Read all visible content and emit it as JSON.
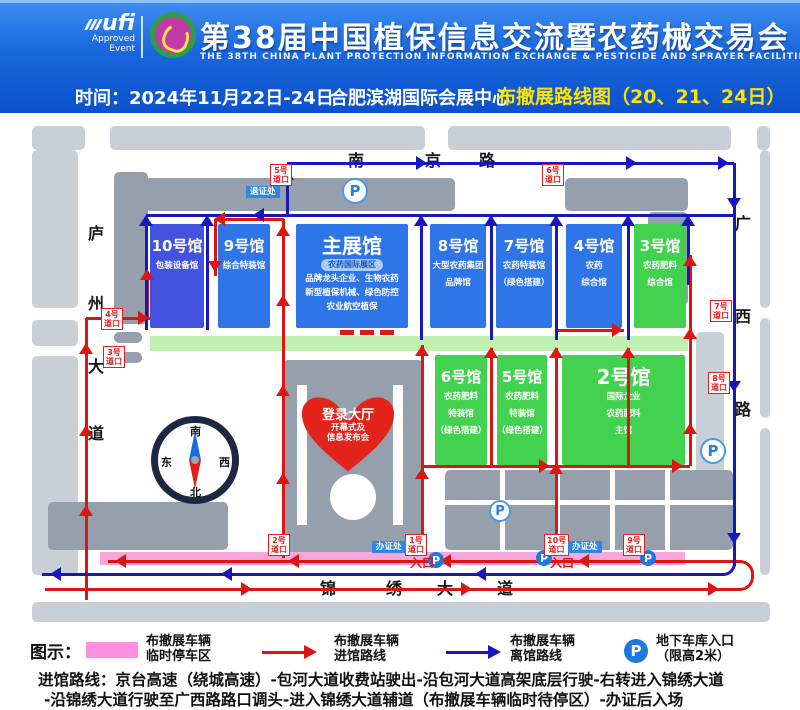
{
  "header": {
    "ufi": {
      "brand": "ufi",
      "approved": "Approved",
      "event": "Event"
    },
    "title": "第38届中国植保信息交流暨农药械交易会",
    "subtitle": "THE 38TH CHINA PLANT PROTECTION INFORMATION EXCHANGE & PESTICIDE AND SPRAYER FACILITIES FAIR",
    "time": "时间：2024年11月22日-24日",
    "venue": "合肥滨湖国际会展中心",
    "route_map_title": "布撤展路线图（20、21、24日）",
    "colors": {
      "header_top": "#3f8ef2",
      "header_bottom": "#0b51cc",
      "highlight": "#ffe300"
    }
  },
  "map": {
    "roads": {
      "north": "南京路",
      "west": "庐州大道",
      "east": "广西路",
      "south": "锦绣大道"
    },
    "halls": [
      {
        "id": "hall10",
        "name": "10号馆",
        "sub": [
          "包装设备馆"
        ],
        "color": "#4353e0",
        "x": 150,
        "y": 224,
        "w": 54,
        "h": 104,
        "big": false
      },
      {
        "id": "hall9",
        "name": "9号馆",
        "sub": [
          "综合特装馆"
        ],
        "color": "#2e75e8",
        "x": 218,
        "y": 224,
        "w": 52,
        "h": 104,
        "big": false
      },
      {
        "id": "main-hall",
        "name": "主展馆",
        "badge": "农药国际展区",
        "sub": [
          "品牌龙头企业、生物农药",
          "新型植保机械、绿色防控",
          "农业航空植保"
        ],
        "color": "#2e75e8",
        "x": 296,
        "y": 224,
        "w": 112,
        "h": 104,
        "big": true
      },
      {
        "id": "hall8",
        "name": "8号馆",
        "sub": [
          "大型农药集团",
          "品牌馆"
        ],
        "color": "#2e75e8",
        "x": 430,
        "y": 224,
        "w": 56,
        "h": 104,
        "big": false
      },
      {
        "id": "hall7",
        "name": "7号馆",
        "sub": [
          "农药特装馆",
          "（绿色搭建）"
        ],
        "color": "#2e75e8",
        "x": 496,
        "y": 224,
        "w": 56,
        "h": 104,
        "big": false
      },
      {
        "id": "hall4",
        "name": "4号馆",
        "sub": [
          "农药",
          "综合馆"
        ],
        "color": "#2e75e8",
        "x": 566,
        "y": 224,
        "w": 56,
        "h": 104,
        "big": false
      },
      {
        "id": "hall3",
        "name": "3号馆",
        "sub": [
          "农药肥料",
          "综合馆"
        ],
        "color": "#43d24f",
        "x": 634,
        "y": 224,
        "w": 52,
        "h": 104,
        "big": false
      },
      {
        "id": "hall6",
        "name": "6号馆",
        "sub": [
          "农药肥料",
          "特装馆",
          "（绿色搭建）"
        ],
        "color": "#43d24f",
        "x": 435,
        "y": 355,
        "w": 52,
        "h": 110,
        "big": false
      },
      {
        "id": "hall5",
        "name": "5号馆",
        "sub": [
          "农药肥料",
          "特装馆",
          "（绿色搭建）"
        ],
        "color": "#43d24f",
        "x": 497,
        "y": 355,
        "w": 50,
        "h": 110,
        "big": false
      },
      {
        "id": "hall2",
        "name": "2号馆",
        "sub": [
          "国际企业",
          "农药肥料",
          "主馆"
        ],
        "color": "#43d24f",
        "x": 562,
        "y": 355,
        "w": 123,
        "h": 110,
        "big": true
      }
    ],
    "login_hall": {
      "title": "登录大厅",
      "sub": [
        "开幕式及",
        "信息发布会"
      ]
    },
    "gates": [
      {
        "label": "5号道口",
        "x": 270,
        "y": 164
      },
      {
        "label": "6号道口",
        "x": 542,
        "y": 164
      },
      {
        "label": "7号道口",
        "x": 710,
        "y": 300
      },
      {
        "label": "8号道口",
        "x": 708,
        "y": 372
      },
      {
        "label": "4号道口",
        "x": 101,
        "y": 308
      },
      {
        "label": "3号道口",
        "x": 103,
        "y": 346
      },
      {
        "label": "2号道口",
        "x": 268,
        "y": 534
      },
      {
        "label": "1号道口",
        "x": 405,
        "y": 534
      },
      {
        "label": "10号道口",
        "x": 544,
        "y": 534
      },
      {
        "label": "9号道口",
        "x": 623,
        "y": 534
      }
    ],
    "stations": [
      {
        "label": "退证处",
        "x": 246,
        "y": 186
      },
      {
        "label": "办证处",
        "x": 372,
        "y": 541
      },
      {
        "label": "办证处",
        "x": 568,
        "y": 541
      }
    ],
    "entrance_label": "入口",
    "compass": {
      "south": "南",
      "north": "北",
      "east": "东",
      "west": "西"
    },
    "parking_letter": "P",
    "colors": {
      "hall_blue": "#2e75e8",
      "hall_indigo": "#4353e0",
      "hall_green": "#43d24f",
      "strip_green": "#bff0b2",
      "route_in": "#dc1712",
      "route_out": "#1717bd",
      "parking_zone": "#f7a6de"
    }
  },
  "legend": {
    "label": "图示：",
    "items": [
      {
        "type": "swatch",
        "line1": "布撤展车辆",
        "line2": "临时停车区"
      },
      {
        "type": "arrow-red",
        "line1": "布撤展车辆",
        "line2": "进馆路线"
      },
      {
        "type": "arrow-blue",
        "line1": "布撤展车辆",
        "line2": "离馆路线"
      },
      {
        "type": "parking",
        "line1": "地下车库入口",
        "line2": "（限高2米）"
      }
    ]
  },
  "route_info": {
    "line1": "进馆路线：京台高速（绕城高速）-包河大道收费站驶出-沿包河大道高架底层行驶-右转进入锦绣大道",
    "line2": "-沿锦绣大道行驶至广西路路口调头-进入锦绣大道辅道（布撤展车辆临时待停区）-办证后入场"
  }
}
